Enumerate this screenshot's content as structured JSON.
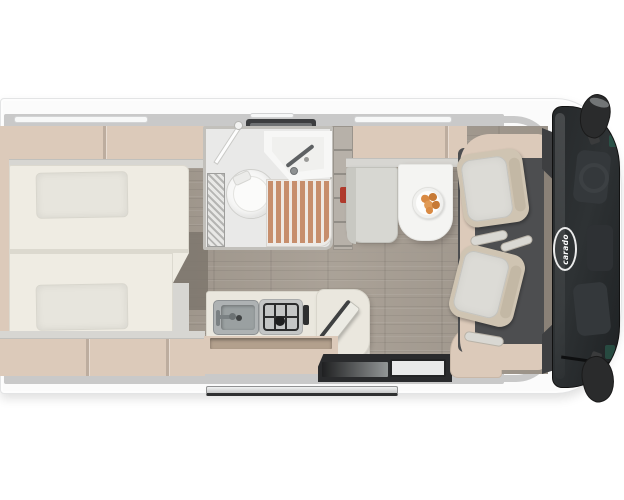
{
  "logo": {
    "brand": "carado"
  },
  "colors": {
    "page-bg": "#ffffff",
    "body-fill": "#fbfbfb",
    "body-edge": "#e3e4e5",
    "wall": "#c9c9c9",
    "window": "#f7f8f8",
    "window-edge": "#d2d3d4",
    "cabinet": "#dccaba",
    "cabinet-dark": "#b3a08d",
    "cabinet-edge": "#d7d6d2",
    "mattress": "#efece3",
    "mattress-edge": "#dcd9cf",
    "pillow": "#e7e5dd",
    "wood": "#a69d92",
    "wood-dark": "#7e776e",
    "bath-floor": "#e9e9e8",
    "bath-wall": "#c2c0bb",
    "fixture-white": "#f7f7f6",
    "slat": "#c78e6c",
    "slat-gap": "#efe9e3",
    "wardrobe": "#b7b1a9",
    "extinguisher": "#b03a2c",
    "bench": "#d7d7d2",
    "table": "#f4f4f2",
    "plate": "#fdfdfc",
    "food-1": "#d98a43",
    "food-2": "#c77a36",
    "food-3": "#e09a55",
    "counter": "#eae7de",
    "steel": "#aeb2b3",
    "steel-dark": "#8d9193",
    "steel-deep": "#9aa0a1",
    "stove-bg": "#c4c6c6",
    "grid": "#2b2c2d",
    "cab-floor": "#4d4e50",
    "seat-back": "#cfc4b2",
    "seat-head": "#c3b8a5",
    "seat-cushion": "#dcdbd6",
    "armrest": "#d9d8d3",
    "entry-dark": "#2a2b2d",
    "pad": "#e9eaea",
    "dash-tan": "#8a8177",
    "apillar": "#3e3f41",
    "glass-1": "#26292b",
    "glass-2": "#2e3234",
    "glass-3": "#1e2123",
    "glass-shape": "#34383b",
    "console": "#2e3134",
    "teal": "#2a5a4c",
    "mirror": "#2a2b2c",
    "step-1": "#f0f1f1",
    "step-2": "#c7c8c9",
    "step-edge": "#2f3031",
    "logo-white": "#ffffff"
  }
}
